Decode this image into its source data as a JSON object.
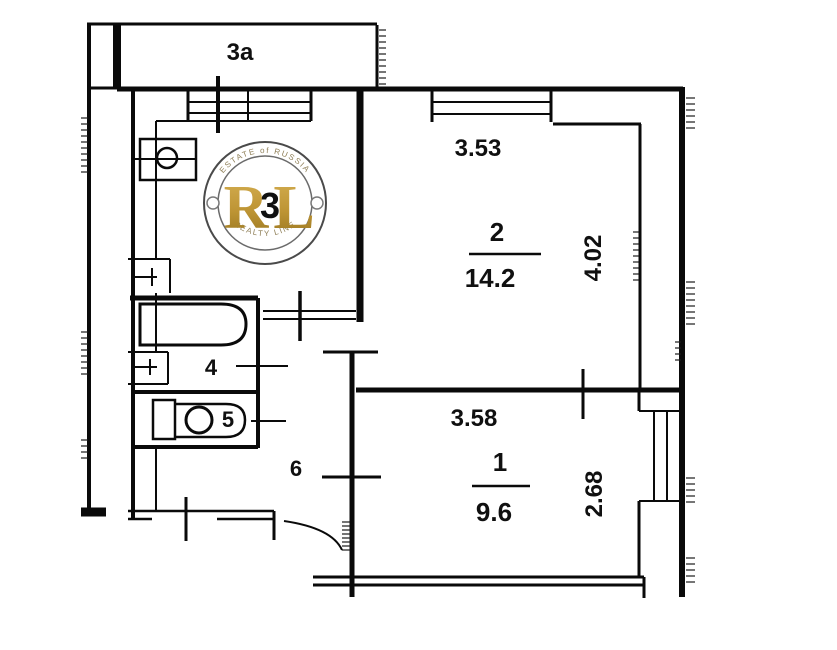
{
  "plan": {
    "balcony": {
      "label": "3a"
    },
    "room2": {
      "number": "2",
      "area": "14.2",
      "width_m": "3.53",
      "depth_m": "4.02"
    },
    "room1": {
      "number": "1",
      "area": "9.6",
      "width_m": "3.58",
      "depth_m": "2.68"
    },
    "kitchen": {
      "number": "3"
    },
    "bathroom": {
      "number": "4"
    },
    "toilet": {
      "number": "5"
    },
    "hallway": {
      "number": "6"
    },
    "ink_color": "#0a0a0a"
  },
  "watermark": {
    "top_arc": "ESTATE of RUSSIA",
    "monogram_left": "R",
    "monogram_right": "L",
    "bottom_arc": "REALTY LINE",
    "gold_color": "#bd9434",
    "ring_color": "#4a4a4a"
  }
}
